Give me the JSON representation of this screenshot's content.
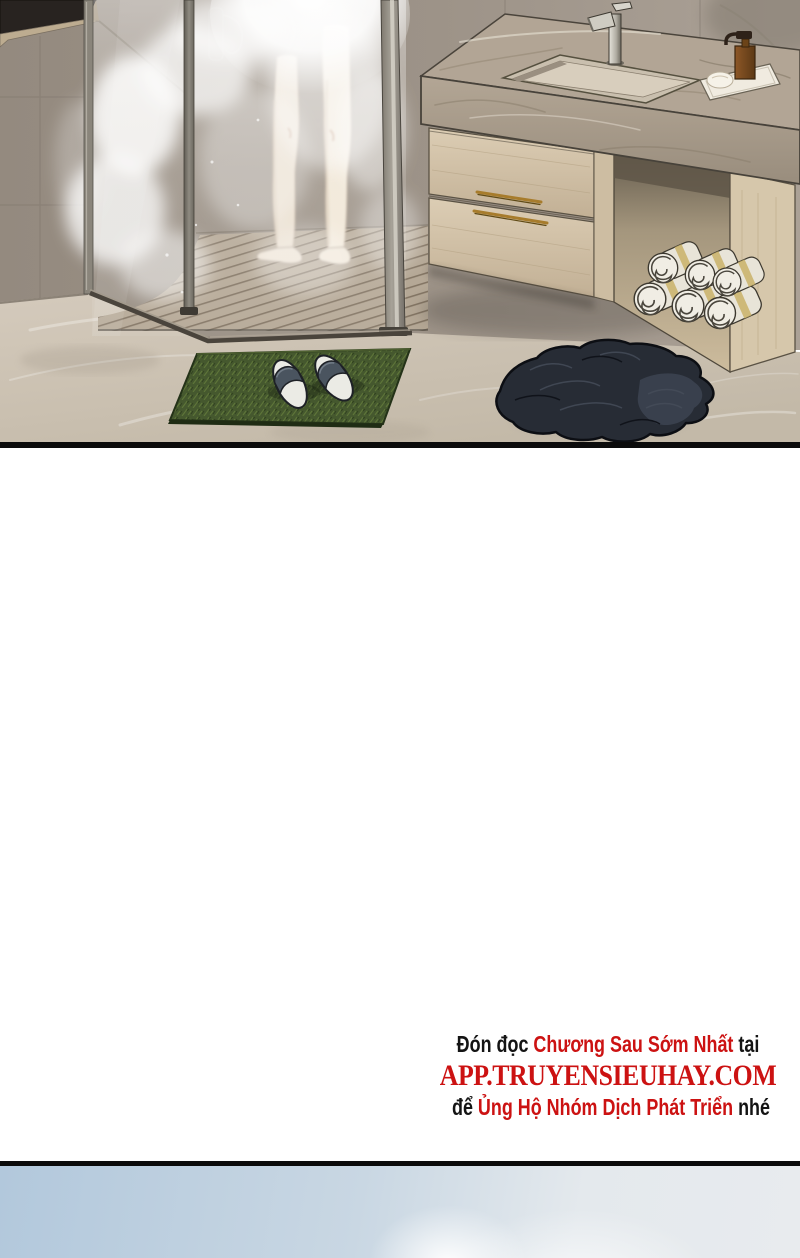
{
  "footer": {
    "line1": {
      "seg1": "Đón đọc ",
      "seg2": "Chương Sau Sớm Nhất",
      "seg3": " tại"
    },
    "line2": "APP.TRUYENSIEUHAY.COM",
    "line3": {
      "seg1": "để ",
      "seg2": "Ủng Hộ Nhóm Dịch Phát Triển",
      "seg3": " nhé"
    }
  },
  "palette": {
    "accent_red": "#cc1212",
    "text_black": "#141414",
    "panel_border_black": "#0b0b0b",
    "marble_wall": "#9c9287",
    "marble_floor": "#ccc2b3",
    "counter_stone": "#b2a595",
    "cabinet_wood": "#d5c6ac",
    "brass_handle": "#a77c2c",
    "mat_green": "#45582e",
    "towel_white": "#f0ede4",
    "clothes_dark": "#272c35",
    "sky_blue": "#b2c8dc"
  },
  "scene": {
    "objects": [
      "bathroom",
      "shower-enclosure",
      "steam",
      "person-legs",
      "wooden-slat-floor",
      "window",
      "vanity-counter",
      "sink",
      "faucet",
      "soap-dispenser",
      "drawers",
      "rolled-towels",
      "grass-bath-mat",
      "slippers",
      "discarded-clothes",
      "sky"
    ]
  }
}
